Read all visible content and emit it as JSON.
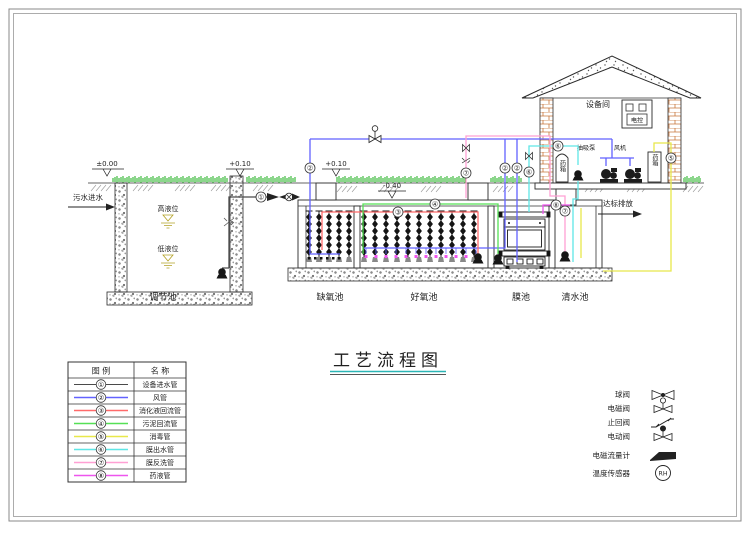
{
  "colors": {
    "c1": "#4a4a4a",
    "c2": "#6262ff",
    "c3": "#ff6a6a",
    "c4": "#55e055",
    "c5": "#e8e84a",
    "c6": "#5fe6e6",
    "c7": "#ffa0d4",
    "c8": "#ee55ee",
    "grass": "#00a500",
    "brick": "#c8763c",
    "level_mark": "#b3a126",
    "title_underline": "#2ab5b5"
  },
  "nums": [
    "①",
    "②",
    "③",
    "④",
    "⑤",
    "⑥",
    "⑦",
    "⑧"
  ],
  "flow": {
    "inlet": "污水进水",
    "outlet": "达标排放"
  },
  "elevations": {
    "ground": "±0.00",
    "wall_top": "+0.10",
    "pier_top": "+0.10",
    "tank_top": "-0.40"
  },
  "tanks": {
    "regulating": "调节池",
    "anoxic": "缺氧池",
    "aerobic": "好氧池",
    "membrane": "膜池",
    "clean": "清水池"
  },
  "levels": {
    "high": "高液位",
    "low": "低液位"
  },
  "building": {
    "name": "设备间",
    "panel": "电控",
    "suction_pump": "抽吸泵",
    "blower": "风机",
    "left_tank": "药箱",
    "right_tank": "药箱"
  },
  "title": {
    "text": "工艺流程图"
  },
  "legend_table": {
    "headers": {
      "symbol": "图 例",
      "name": "名 称"
    },
    "rows": [
      {
        "num": "①",
        "name": "设备进水管",
        "color": "#4a4a4a"
      },
      {
        "num": "②",
        "name": "风管",
        "color": "#6262ff"
      },
      {
        "num": "③",
        "name": "消化液回流管",
        "color": "#ff6a6a"
      },
      {
        "num": "④",
        "name": "污泥回流管",
        "color": "#55e055"
      },
      {
        "num": "⑤",
        "name": "消毒管",
        "color": "#e8e84a"
      },
      {
        "num": "⑥",
        "name": "膜出水管",
        "color": "#5fe6e6"
      },
      {
        "num": "⑦",
        "name": "膜反洗管",
        "color": "#ffa0d4"
      },
      {
        "num": "⑧",
        "name": "药液管",
        "color": "#ee55ee"
      }
    ]
  },
  "valve_legend": {
    "items": [
      {
        "label": "球阀"
      },
      {
        "label": "电磁阀"
      },
      {
        "label": "止回阀"
      },
      {
        "label": "电动阀"
      },
      {
        "label": "电磁流量计"
      },
      {
        "label": "温度传感器"
      }
    ],
    "sensor_text": "RH"
  }
}
